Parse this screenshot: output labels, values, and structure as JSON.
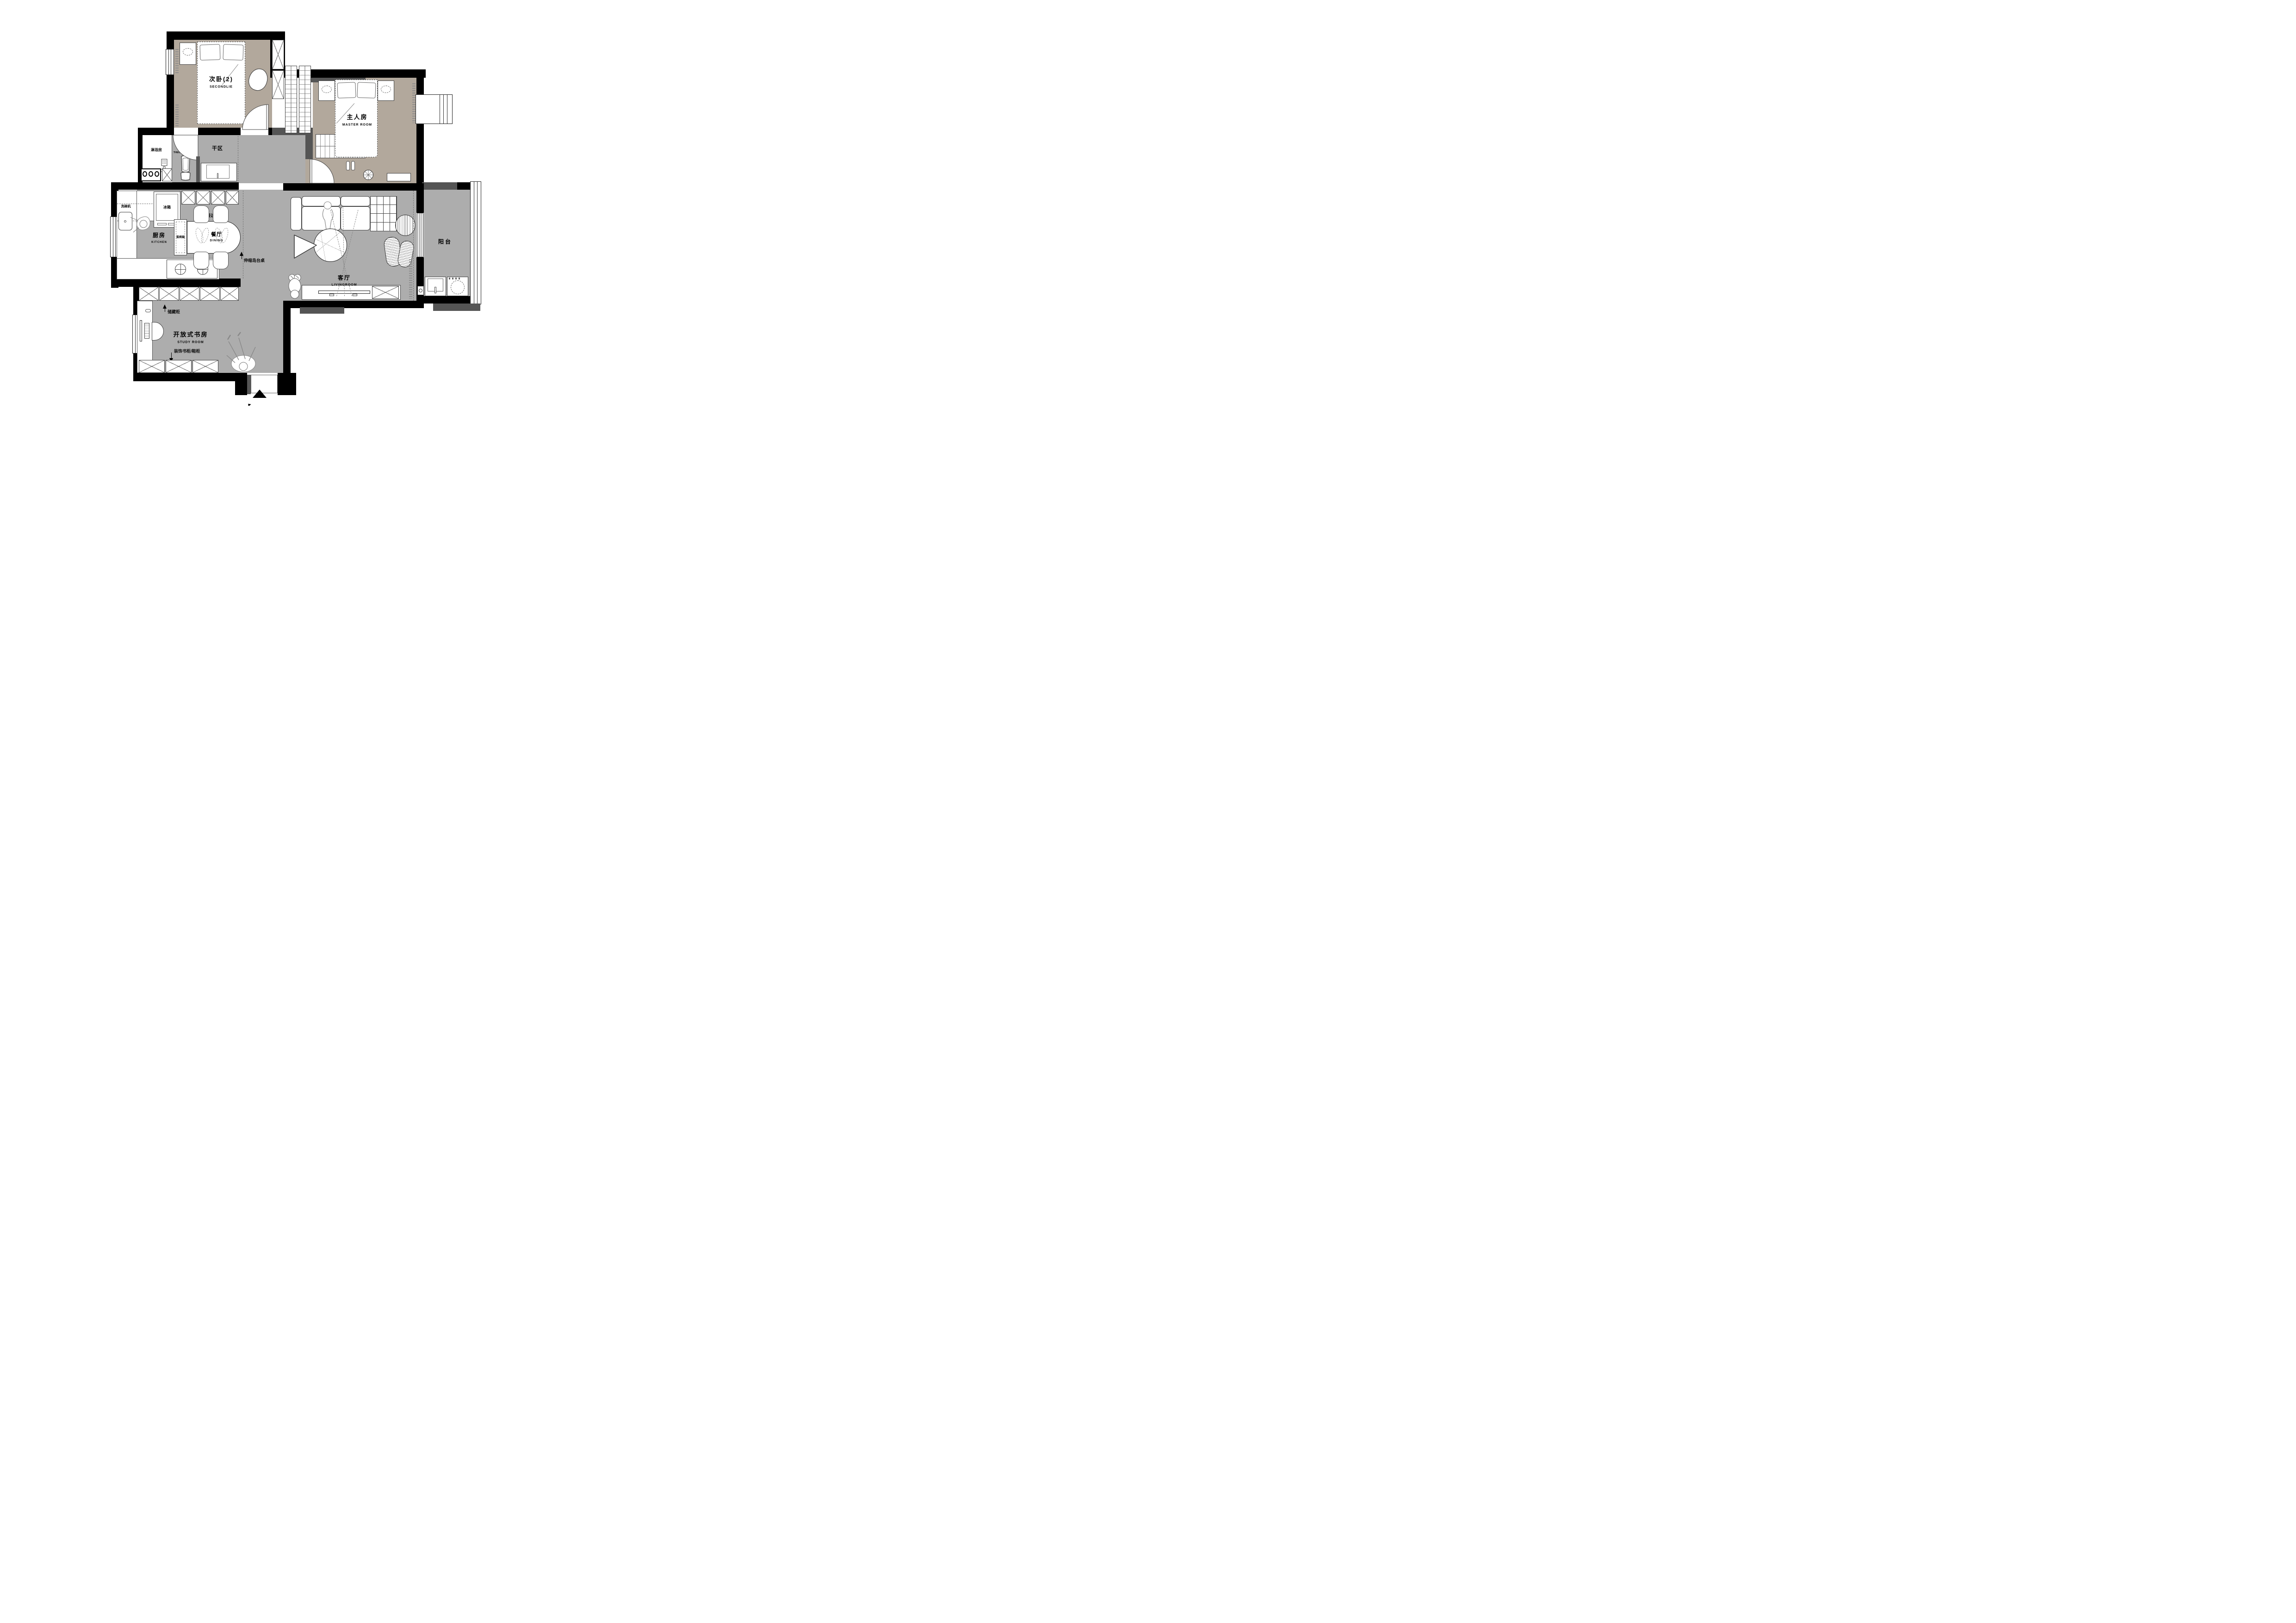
{
  "plan": {
    "title": "apartment floor plan",
    "rooms": {
      "second_bedroom": {
        "name_zh": "次卧(2)",
        "name_en": "SECONDLIE"
      },
      "master_bedroom": {
        "name_zh": "主人房",
        "name_en": "MASTER ROOM"
      },
      "outer_bath": {
        "name_zh": "外卫",
        "name_en": "THEOUTERGUARD"
      },
      "shower_room": {
        "name_zh": "淋浴房"
      },
      "dry_area": {
        "name_zh": "干区"
      },
      "kitchen": {
        "name_zh": "厨房",
        "name_en": "KITCHEN"
      },
      "dining": {
        "name_zh": "餐厅",
        "name_en": "DINING"
      },
      "living": {
        "name_zh": "客厅",
        "name_en": "LIVINGROOM"
      },
      "balcony": {
        "name_zh": "阳台"
      },
      "study": {
        "name_zh": "开放式书房",
        "name_en": "STUDY ROOM"
      }
    },
    "annotations": {
      "fridge": "冰箱",
      "sideboard": "餐边柜",
      "dishwasher": "洗碗机",
      "steam_oven": "蒸烤箱",
      "island_table": "伸缩岛台桌",
      "storage_cabinet": "储藏柜",
      "deco_cabinet": "装饰书柜/鞋柜"
    },
    "icons": {
      "entry_arrow": "filled triangle pointing up at main entrance"
    },
    "colors": {
      "wall": "#000000",
      "wall_accent": "#555555",
      "floor_hard": "#adadad",
      "floor_wood": "#b2a89c",
      "background": "#ffffff"
    }
  }
}
